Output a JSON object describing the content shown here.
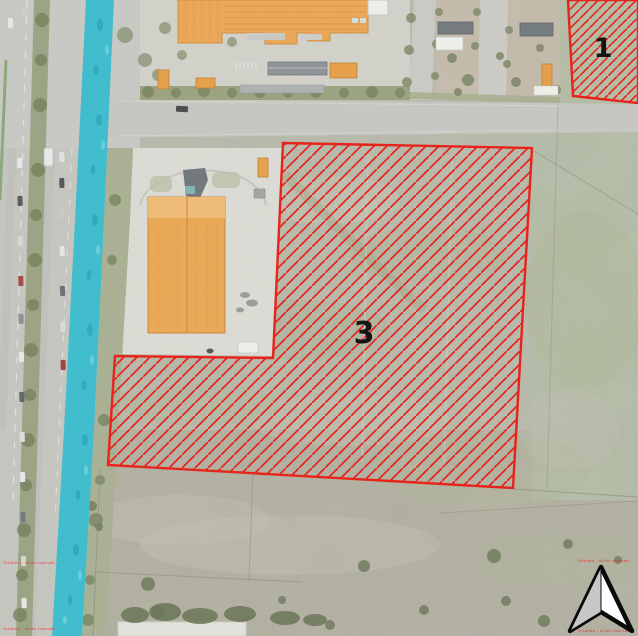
{
  "map": {
    "kind": "aerial-orthophoto-with-parcel-overlay",
    "parcels": [
      {
        "id": "1",
        "label": "1",
        "outline_color": "#e8231b",
        "hatch": "diagonal-red"
      },
      {
        "id": "3",
        "label": "3",
        "outline_color": "#e8231b",
        "hatch": "diagonal-red"
      }
    ],
    "watermark_text": "Ortofoto - diritti riservati",
    "icons": {
      "north_arrow": "north-arrow-icon"
    },
    "colors": {
      "parcel_outline": "#e8231b",
      "canal_highlight": "#3dbdce",
      "building_orange": "#eca757",
      "grass_base": "#b7b9aa",
      "road_gray": "#c7c7c2",
      "label_text": "#141414",
      "watermark_red": "#e5322b"
    }
  }
}
